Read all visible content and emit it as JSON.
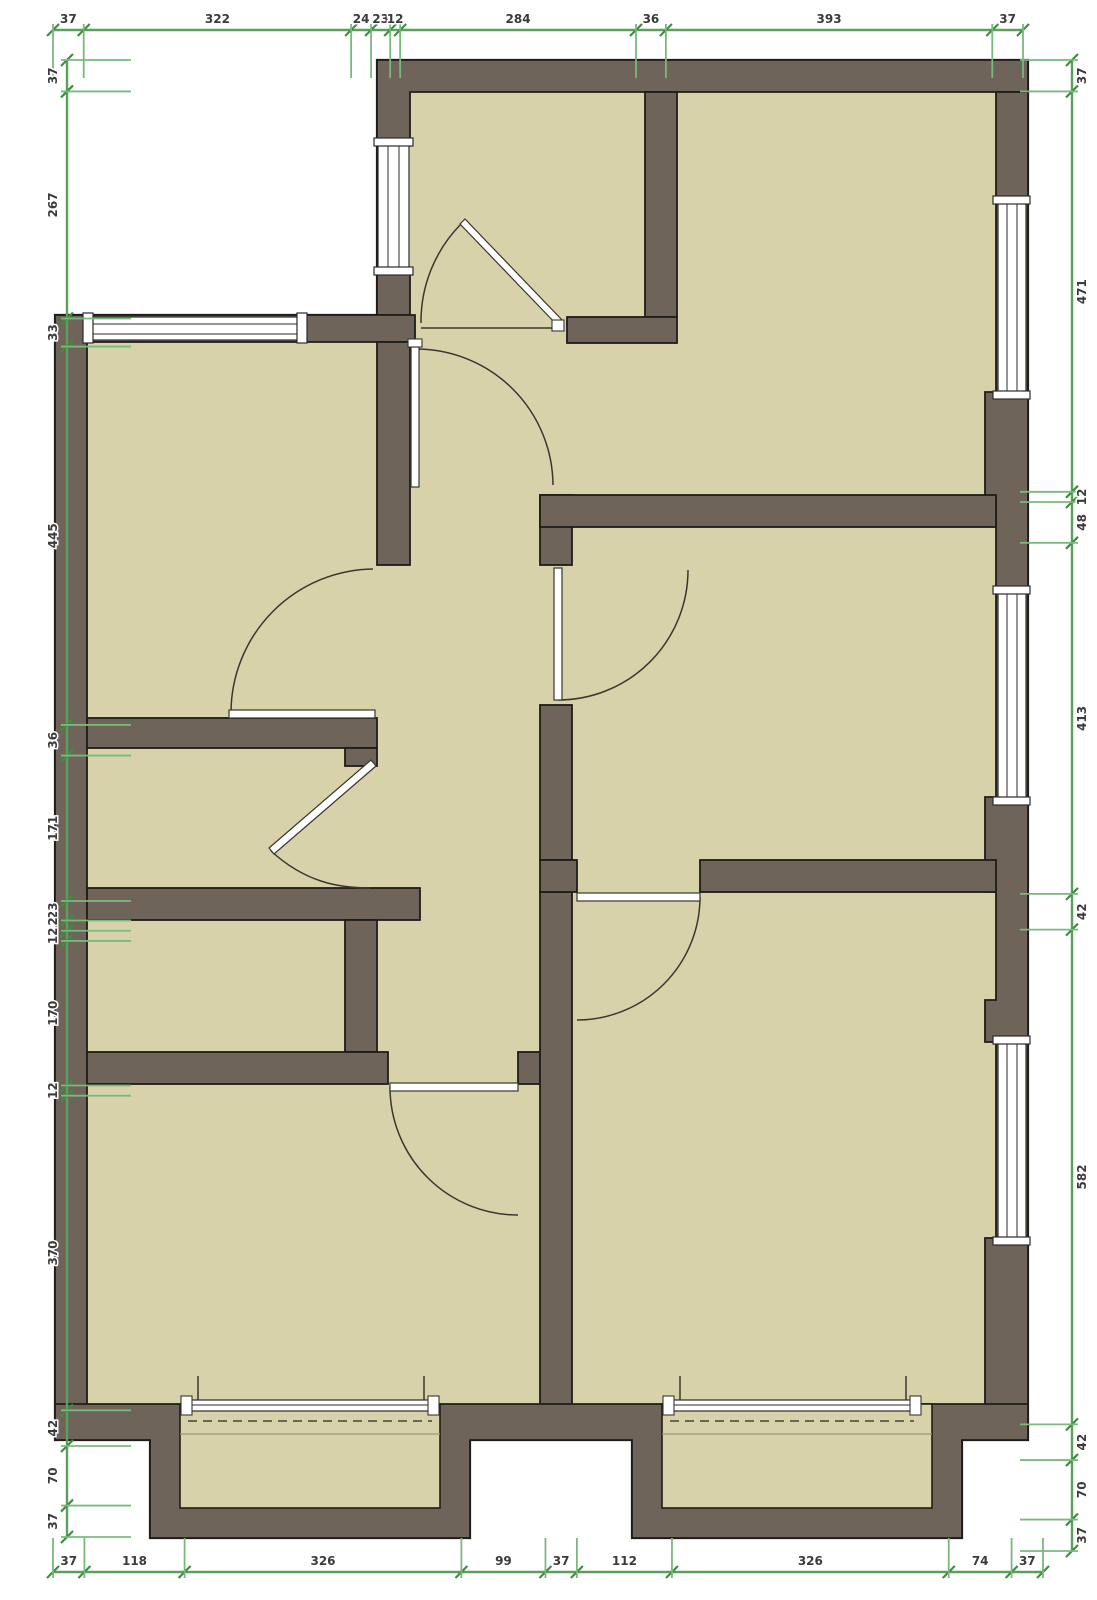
{
  "drawing": {
    "kind": "architectural floor plan",
    "view": "top-down plan with dimension chains on all four sides"
  },
  "colors": {
    "wall": "#6e6459",
    "room": "#d8d2ab",
    "outline": "#1f1d19",
    "dimension_line": "#5aa05a",
    "dimension_tick": "#3e8e41",
    "dimension_ext": "#7ab87c",
    "dimension_text": "#3b3b3b",
    "background": "#ffffff",
    "door": "#3a362e"
  },
  "dimensions": {
    "top": {
      "values": [
        37,
        322,
        24,
        23,
        12,
        284,
        36,
        393,
        37
      ]
    },
    "bottom": {
      "values": [
        37,
        118,
        326,
        99,
        37,
        112,
        326,
        74,
        37
      ]
    },
    "left": {
      "values": [
        37,
        267,
        33,
        445,
        36,
        171,
        23,
        12,
        12,
        170,
        12,
        370,
        42,
        70,
        37
      ]
    },
    "right": {
      "values": [
        37,
        471,
        12,
        48,
        413,
        42,
        582,
        42,
        70,
        37
      ]
    }
  }
}
